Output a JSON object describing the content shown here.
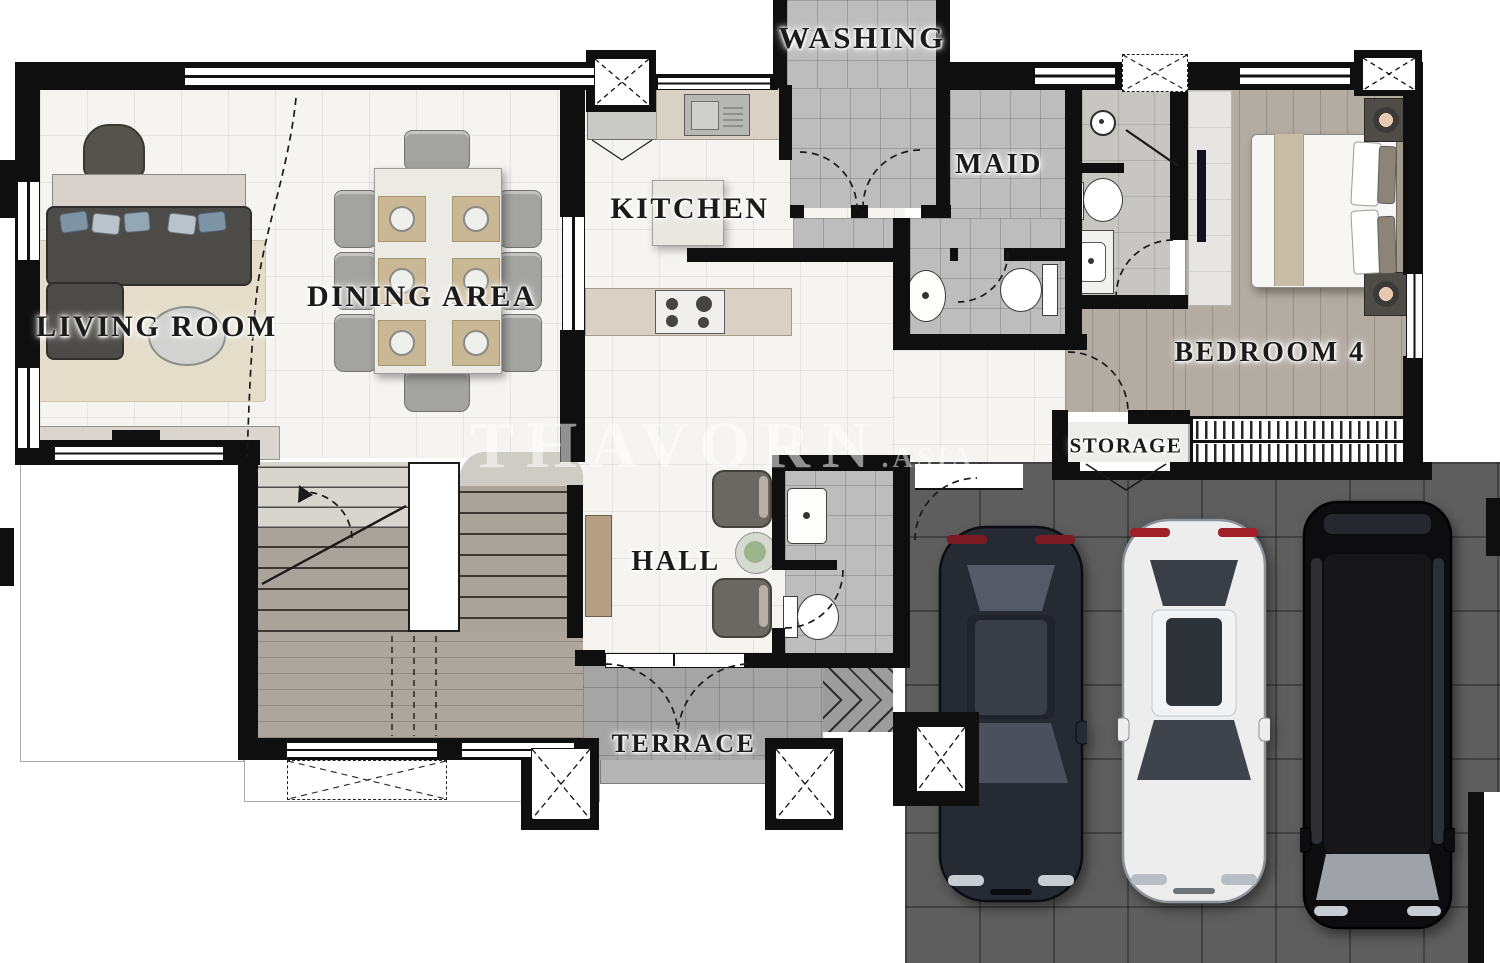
{
  "watermark": {
    "text": "THAVORN",
    "suffix": ".ASIA"
  },
  "rooms": {
    "living": {
      "label": "LIVING ROOM"
    },
    "dining": {
      "label": "DINING AREA"
    },
    "kitchen": {
      "label": "KITCHEN"
    },
    "washing": {
      "label": "WASHING"
    },
    "maid": {
      "label": "MAID"
    },
    "bedroom4": {
      "label": "BEDROOM 4"
    },
    "hall": {
      "label": "HALL"
    },
    "storage": {
      "label": "STORAGE"
    },
    "terrace": {
      "label": "TERRACE"
    }
  },
  "palette": {
    "wall": "#0f0f0f",
    "floor_light": "#f5f4f1",
    "floor_tile_gray": "#bdbdbd",
    "floor_wood": "#b2aca3",
    "floor_terrace": "#a5a5a5",
    "floor_garage": "#5e5e5e",
    "rug": "#e4ddca",
    "sofa": "#4d4b48",
    "marble": "#eceae5",
    "counter": "#d9d2c4",
    "car_dark": "#262a33",
    "car_white": "#ededee",
    "car_suv_black": "#0d0d0f",
    "taillight_red": "#8f1d24"
  },
  "vehicles": [
    {
      "type": "sedan",
      "color": "#262a33"
    },
    {
      "type": "sedan",
      "color": "#ededee"
    },
    {
      "type": "suv",
      "color": "#0d0d0f"
    }
  ]
}
